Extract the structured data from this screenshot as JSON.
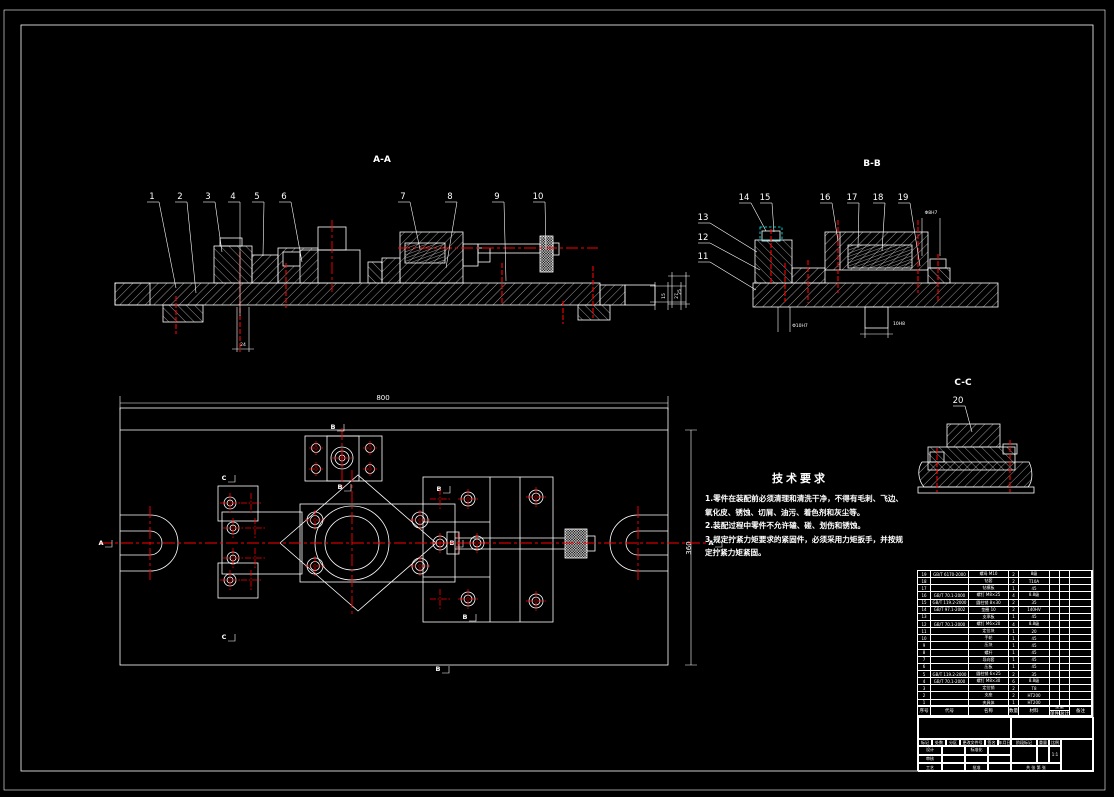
{
  "sheet": {
    "bg": "#000000",
    "line": "#ffffff",
    "red": "#ff0000",
    "cyan": "#00ffff"
  },
  "views": {
    "aa": "A-A",
    "bb": "B-B",
    "cc": "C-C"
  },
  "callouts": {
    "aa": [
      {
        "n": "1",
        "x": 152,
        "y": 200,
        "tx": 176,
        "ty": 288
      },
      {
        "n": "2",
        "x": 180,
        "y": 200,
        "tx": 196,
        "ty": 293
      },
      {
        "n": "3",
        "x": 208,
        "y": 200,
        "tx": 222,
        "ty": 252
      },
      {
        "n": "4",
        "x": 233,
        "y": 200,
        "tx": 240,
        "ty": 316
      },
      {
        "n": "5",
        "x": 257,
        "y": 200,
        "tx": 263,
        "ty": 256
      },
      {
        "n": "6",
        "x": 284,
        "y": 200,
        "tx": 302,
        "ty": 262
      },
      {
        "n": "7",
        "x": 403,
        "y": 200,
        "tx": 420,
        "ty": 249
      },
      {
        "n": "8",
        "x": 450,
        "y": 200,
        "tx": 446,
        "ty": 268
      },
      {
        "n": "9",
        "x": 497,
        "y": 200,
        "tx": 506,
        "ty": 281
      },
      {
        "n": "10",
        "x": 538,
        "y": 200,
        "tx": 546,
        "ty": 249
      }
    ],
    "bb": [
      {
        "n": "11",
        "x": 703,
        "y": 260,
        "tx": 756,
        "ty": 290
      },
      {
        "n": "12",
        "x": 703,
        "y": 241,
        "tx": 760,
        "ty": 270
      },
      {
        "n": "13",
        "x": 703,
        "y": 221,
        "tx": 757,
        "ty": 252
      },
      {
        "n": "14",
        "x": 744,
        "y": 201,
        "tx": 766,
        "ty": 231
      },
      {
        "n": "15",
        "x": 765,
        "y": 201,
        "tx": 774,
        "ty": 232
      },
      {
        "n": "16",
        "x": 825,
        "y": 201,
        "tx": 838,
        "ty": 241
      },
      {
        "n": "17",
        "x": 852,
        "y": 201,
        "tx": 858,
        "ty": 248
      },
      {
        "n": "18",
        "x": 878,
        "y": 201,
        "tx": 882,
        "ty": 251
      },
      {
        "n": "19",
        "x": 903,
        "y": 201,
        "tx": 920,
        "ty": 266
      }
    ],
    "cc": [
      {
        "n": "20",
        "x": 958,
        "y": 404,
        "tx": 972,
        "ty": 432
      }
    ]
  },
  "marks": [
    {
      "t": "A",
      "x": 101,
      "y": 545
    },
    {
      "t": "A",
      "x": 711,
      "y": 545
    },
    {
      "t": "B",
      "x": 333,
      "y": 429
    },
    {
      "t": "B",
      "x": 340,
      "y": 489
    },
    {
      "t": "B",
      "x": 439,
      "y": 491
    },
    {
      "t": "B",
      "x": 452,
      "y": 545
    },
    {
      "t": "B",
      "x": 465,
      "y": 619
    },
    {
      "t": "B",
      "x": 438,
      "y": 671
    },
    {
      "t": "C",
      "x": 224,
      "y": 480
    },
    {
      "t": "C",
      "x": 224,
      "y": 639
    }
  ],
  "dims": {
    "plan_width": "800",
    "plan_height": "360",
    "aa_step1": "15",
    "aa_step2": "27",
    "aa_slot": "24",
    "bb_height": "25",
    "bb_hole": "Φ10H7",
    "bb_slot": "10H8",
    "bb_pin": "Φ8H7"
  },
  "tech": {
    "title": "技术要求",
    "lines": [
      "1.零件在装配前必须清理和清洗干净，不得有毛刺、飞边、",
      "氧化皮、锈蚀、切屑、油污、着色剂和灰尘等。",
      "2.装配过程中零件不允许磕、碰、划伤和锈蚀。",
      "3.规定拧紧力矩要求的紧固件，必须采用力矩扳手，并按规",
      "定拧紧力矩紧固。"
    ]
  },
  "bom": {
    "headers": [
      "序号",
      "代号",
      "名称",
      "数量",
      "材料",
      "单件",
      "总计",
      "备注"
    ],
    "weight_header": "重量",
    "rows": [
      [
        "19",
        "GB/T 6170-2000",
        "螺母 M10",
        "2",
        "8级",
        ""
      ],
      [
        "18",
        "",
        "钻套",
        "2",
        "T10A",
        ""
      ],
      [
        "17",
        "",
        "钻模板",
        "1",
        "45",
        ""
      ],
      [
        "16",
        "GB/T 70.1-2000",
        "螺钉 M8×25",
        "4",
        "8.8级",
        ""
      ],
      [
        "15",
        "GB/T 119.2-2000",
        "圆柱销 8×30",
        "2",
        "35",
        ""
      ],
      [
        "14",
        "GB/T 97.1-2002",
        "垫圈 10",
        "2",
        "140HV",
        ""
      ],
      [
        "13",
        "",
        "支承板",
        "1",
        "45",
        ""
      ],
      [
        "12",
        "GB/T 70.1-2000",
        "螺钉 M6×20",
        "4",
        "8.8级",
        ""
      ],
      [
        "11",
        "",
        "定位块",
        "1",
        "20",
        ""
      ],
      [
        "10",
        "",
        "手轮",
        "1",
        "45",
        ""
      ],
      [
        "9",
        "",
        "压块",
        "1",
        "45",
        ""
      ],
      [
        "8",
        "",
        "螺杆",
        "1",
        "45",
        ""
      ],
      [
        "7",
        "",
        "导向套",
        "1",
        "45",
        ""
      ],
      [
        "6",
        "",
        "压板",
        "1",
        "45",
        ""
      ],
      [
        "5",
        "GB/T 119.2-2000",
        "圆柱销 6×25",
        "2",
        "35",
        ""
      ],
      [
        "4",
        "GB/T 70.1-2000",
        "螺钉 M8×30",
        "6",
        "8.8级",
        ""
      ],
      [
        "3",
        "",
        "定位销",
        "2",
        "T8",
        ""
      ],
      [
        "2",
        "",
        "支座",
        "2",
        "HT200",
        ""
      ],
      [
        "1",
        "",
        "夹具体",
        "1",
        "HT200",
        ""
      ]
    ]
  },
  "titleblock": {
    "mark_row": [
      "标记",
      "处数",
      "分区",
      "更改文件号",
      "签名",
      "年月日"
    ],
    "roles": [
      "设计",
      "审核",
      "工艺"
    ],
    "roles2": [
      "标准化",
      "",
      "批准"
    ],
    "stage": "阶段标记",
    "weight": "重量",
    "scale": "比例",
    "scale_value": "1:1",
    "sheets": "共 张 第 张"
  }
}
